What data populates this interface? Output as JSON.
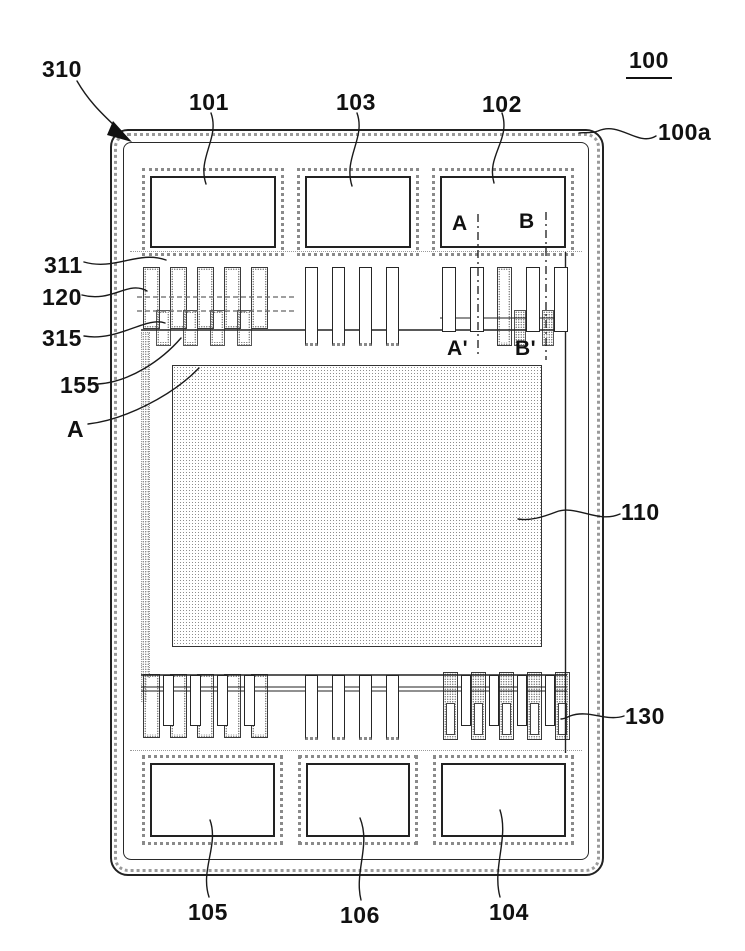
{
  "figure": {
    "labels": {
      "l310": "310",
      "l101": "101",
      "l103": "103",
      "l102": "102",
      "l100": "100",
      "l100a": "100a",
      "l311": "311",
      "l120": "120",
      "l315": "315",
      "l155": "155",
      "lA": "A",
      "l110": "110",
      "l130": "130",
      "l105": "105",
      "l106": "106",
      "l104": "104",
      "secA": "A",
      "secB": "B",
      "secAprime": "A'",
      "secBprime": "B'"
    },
    "colors": {
      "line": "#1a1a1a",
      "texture": "#8a8a8a",
      "background": "#ffffff"
    }
  }
}
